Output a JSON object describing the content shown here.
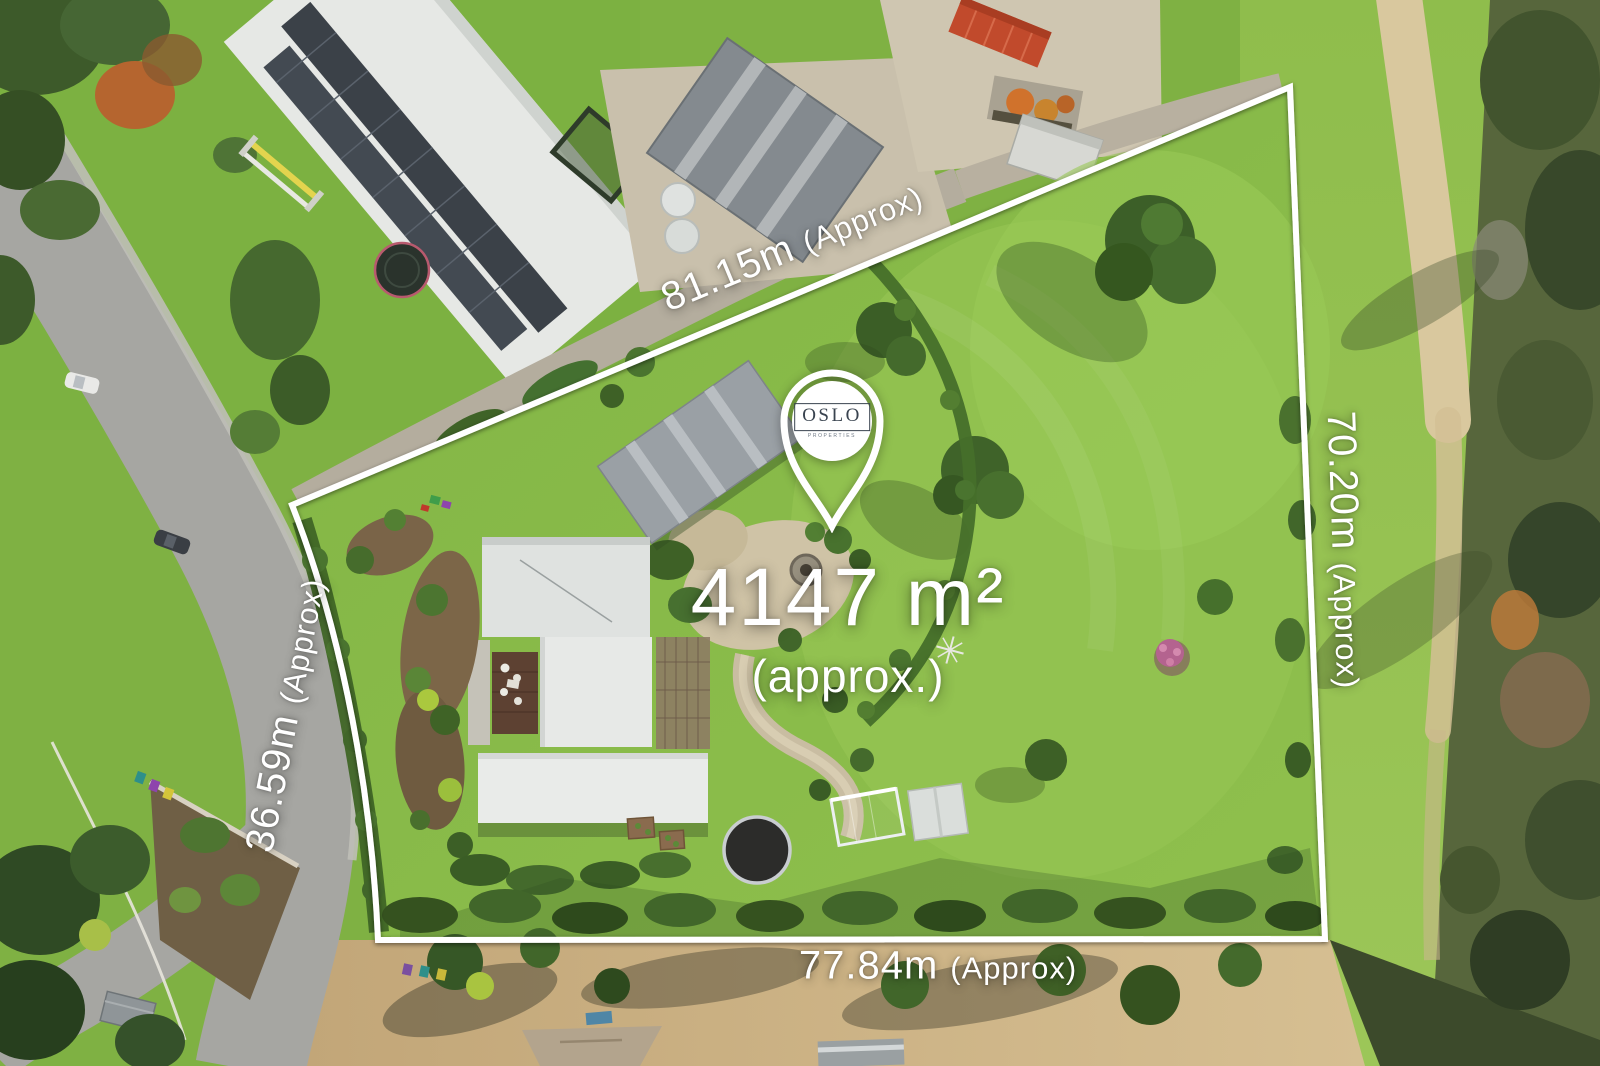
{
  "property_overlay": {
    "area": {
      "value": "4147 m²",
      "qualifier": "(approx.)"
    },
    "boundaries": {
      "top": {
        "length": "81.15m",
        "qualifier": "(Approx)"
      },
      "right": {
        "length": "70.20m",
        "qualifier": "(Approx)"
      },
      "bottom": {
        "length": "77.84m",
        "qualifier": "(Approx)"
      },
      "left": {
        "length": "36.59m",
        "qualifier": "(Approx)"
      }
    },
    "pin": {
      "icon": "map-pin",
      "brand": "OSLO",
      "brand_subtext": "PROPERTIES"
    },
    "colors": {
      "overlay_white": "#ffffff",
      "brand_navy": "#39434f",
      "boundary_line": "#ffffff"
    }
  }
}
